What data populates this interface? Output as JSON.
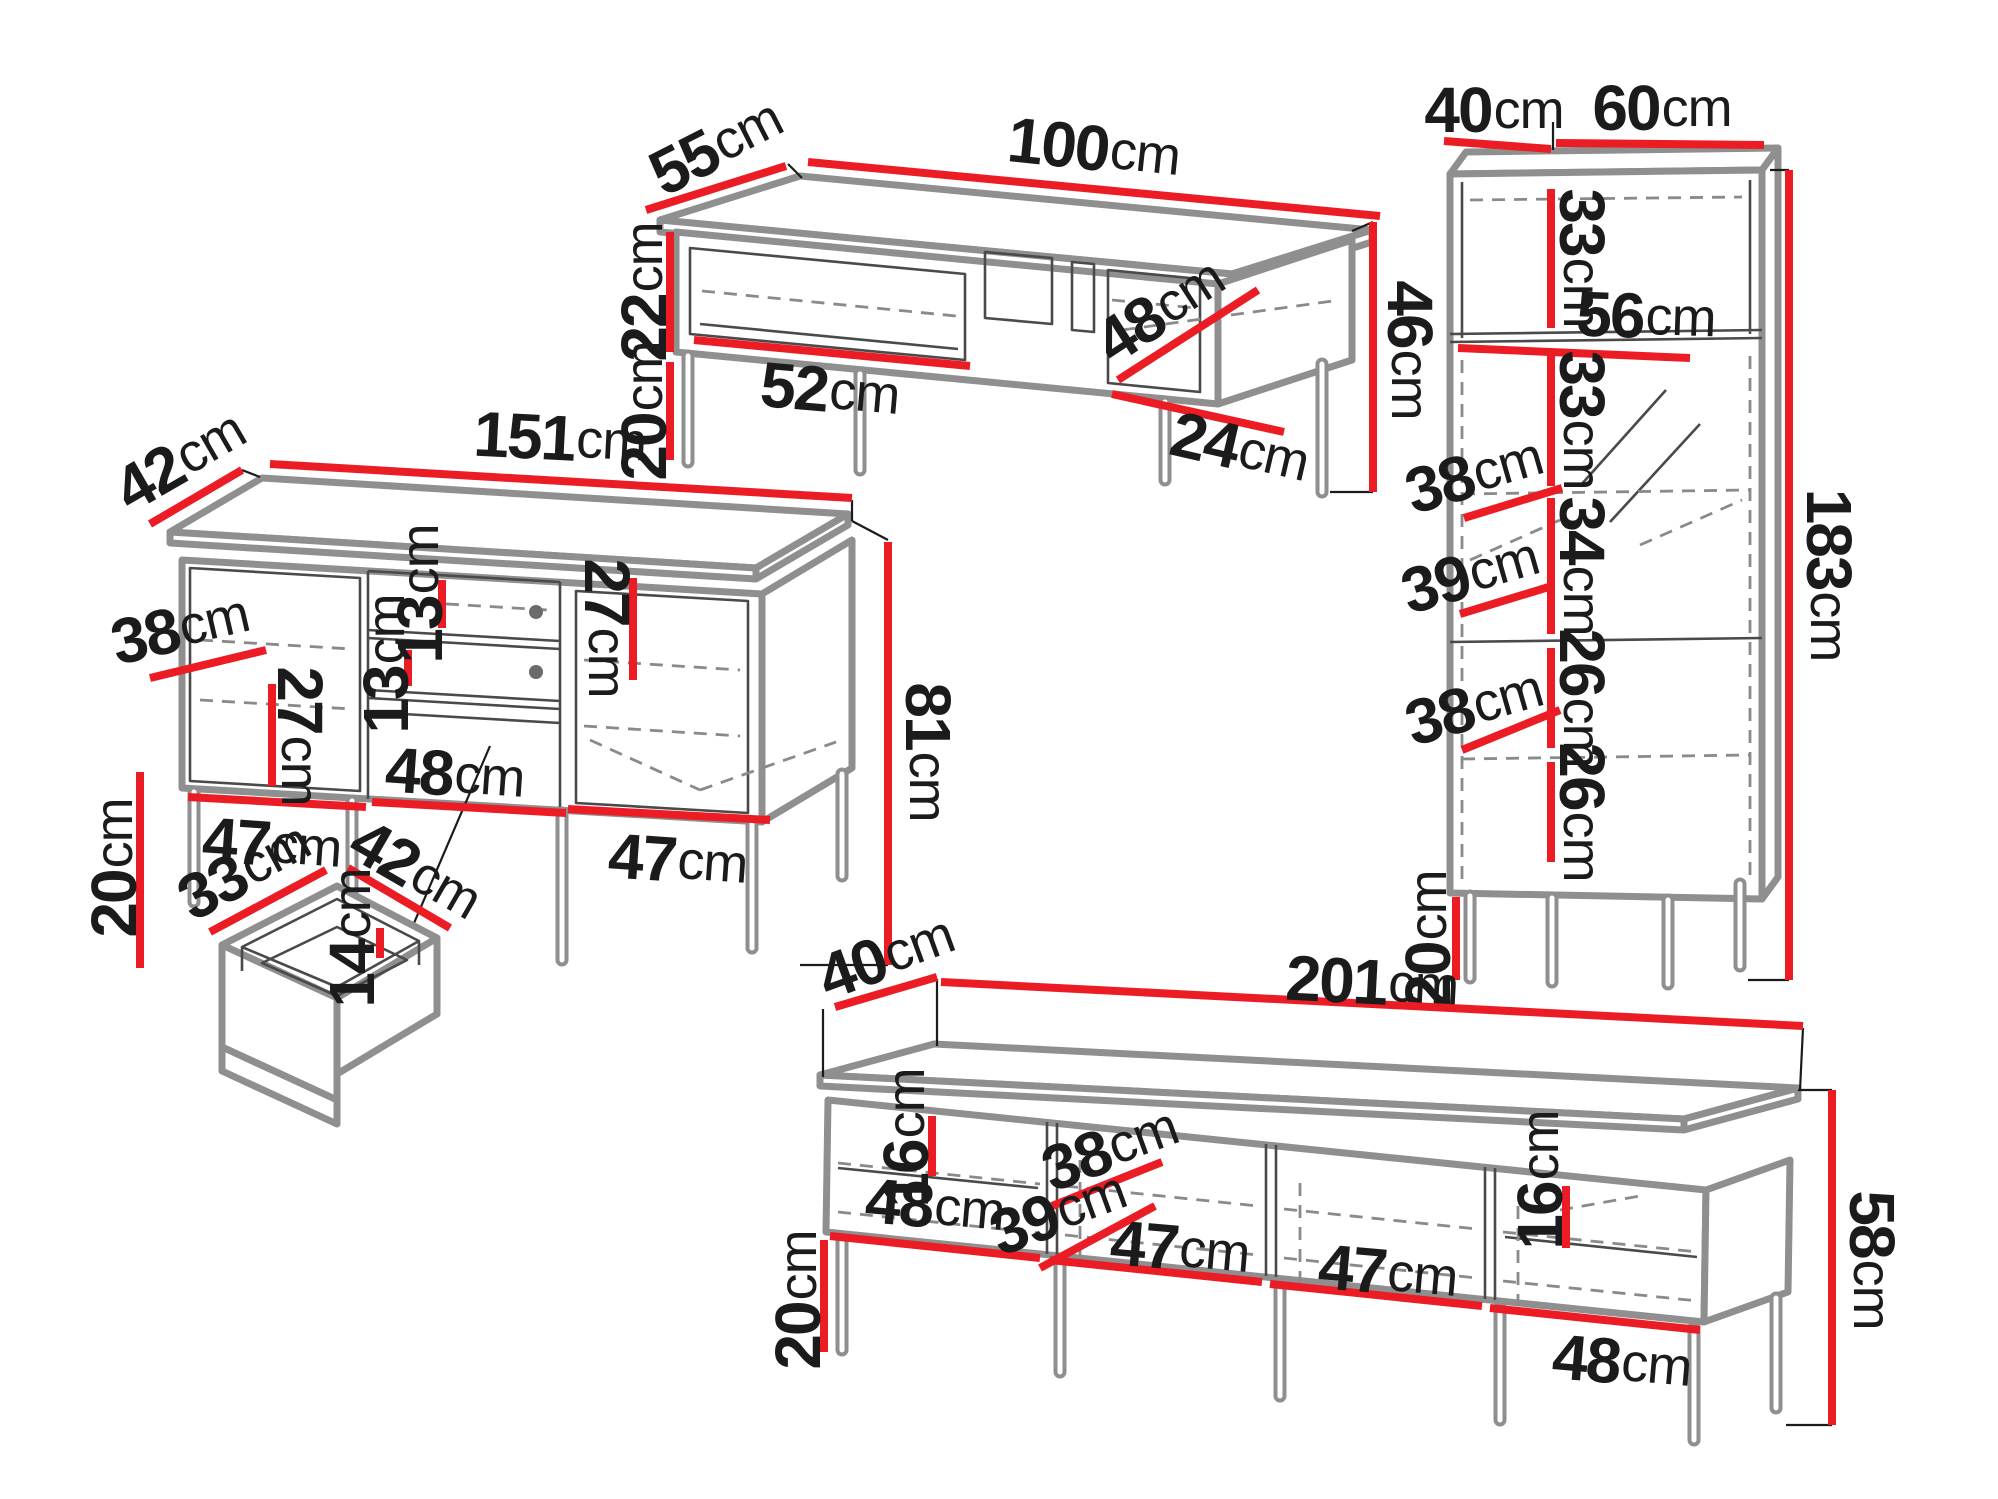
{
  "colors": {
    "dimension_line": "#ec1c24",
    "drawing_outline": "#8f8f8f",
    "detail_line": "#4a4a4a",
    "label_text": "#1b1b1b",
    "background": "#ffffff"
  },
  "figures": {
    "coffee_table": {
      "labels": {
        "depth": {
          "n": "55",
          "u": "cm"
        },
        "width": {
          "n": "100",
          "u": "cm"
        },
        "carcass_height": {
          "n": "22",
          "u": "cm"
        },
        "leg_height": {
          "n": "20",
          "u": "cm"
        },
        "shelf_width": {
          "n": "52",
          "u": "cm"
        },
        "inner_depth": {
          "n": "48",
          "u": "cm"
        },
        "niche_width": {
          "n": "24",
          "u": "cm"
        },
        "total_height": {
          "n": "46",
          "u": "cm"
        }
      }
    },
    "sideboard": {
      "labels": {
        "depth": {
          "n": "42",
          "u": "cm"
        },
        "width": {
          "n": "151",
          "u": "cm"
        },
        "upper_shelf_gap": {
          "n": "13",
          "u": "cm"
        },
        "lower_shelf_gap": {
          "n": "13",
          "u": "cm"
        },
        "inner_depth": {
          "n": "38",
          "u": "cm"
        },
        "left_inner_height": {
          "n": "27",
          "u": "cm"
        },
        "right_inner_height": {
          "n": "27",
          "u": "cm"
        },
        "niche_width": {
          "n": "48",
          "u": "cm"
        },
        "left_door_width": {
          "n": "47",
          "u": "cm"
        },
        "right_door_width": {
          "n": "47",
          "u": "cm"
        },
        "leg_height": {
          "n": "20",
          "u": "cm"
        },
        "total_height": {
          "n": "81",
          "u": "cm"
        }
      }
    },
    "drawer_detail": {
      "labels": {
        "depth": {
          "n": "33",
          "u": "cm"
        },
        "width": {
          "n": "42",
          "u": "cm"
        },
        "height": {
          "n": "14",
          "u": "cm"
        }
      }
    },
    "tall_cabinet": {
      "labels": {
        "depth": {
          "n": "40",
          "u": "cm"
        },
        "width": {
          "n": "60",
          "u": "cm"
        },
        "top_section_height": {
          "n": "33",
          "u": "cm"
        },
        "shelf_width": {
          "n": "56",
          "u": "cm"
        },
        "upper_section_height": {
          "n": "33",
          "u": "cm"
        },
        "upper_inner_depth": {
          "n": "38",
          "u": "cm"
        },
        "display_section_height": {
          "n": "34",
          "u": "cm"
        },
        "middle_inner_depth": {
          "n": "39",
          "u": "cm"
        },
        "lower_section_height": {
          "n": "26",
          "u": "cm"
        },
        "lower_inner_depth": {
          "n": "38",
          "u": "cm"
        },
        "bottom_section_height": {
          "n": "26",
          "u": "cm"
        },
        "leg_height": {
          "n": "20",
          "u": "cm"
        },
        "total_height": {
          "n": "183",
          "u": "cm"
        }
      }
    },
    "tv_stand": {
      "labels": {
        "depth": {
          "n": "40",
          "u": "cm"
        },
        "width": {
          "n": "201",
          "u": "cm"
        },
        "left_shelf_gap": {
          "n": "16",
          "u": "cm"
        },
        "upper_inner_depth": {
          "n": "38",
          "u": "cm"
        },
        "compartment1_width": {
          "n": "48",
          "u": "cm"
        },
        "lower_inner_depth": {
          "n": "39",
          "u": "cm"
        },
        "compartment2_width": {
          "n": "47",
          "u": "cm"
        },
        "compartment3_width": {
          "n": "47",
          "u": "cm"
        },
        "right_shelf_gap": {
          "n": "16",
          "u": "cm"
        },
        "compartment4_width": {
          "n": "48",
          "u": "cm"
        },
        "leg_height": {
          "n": "20",
          "u": "cm"
        },
        "total_height": {
          "n": "58",
          "u": "cm"
        }
      }
    }
  }
}
